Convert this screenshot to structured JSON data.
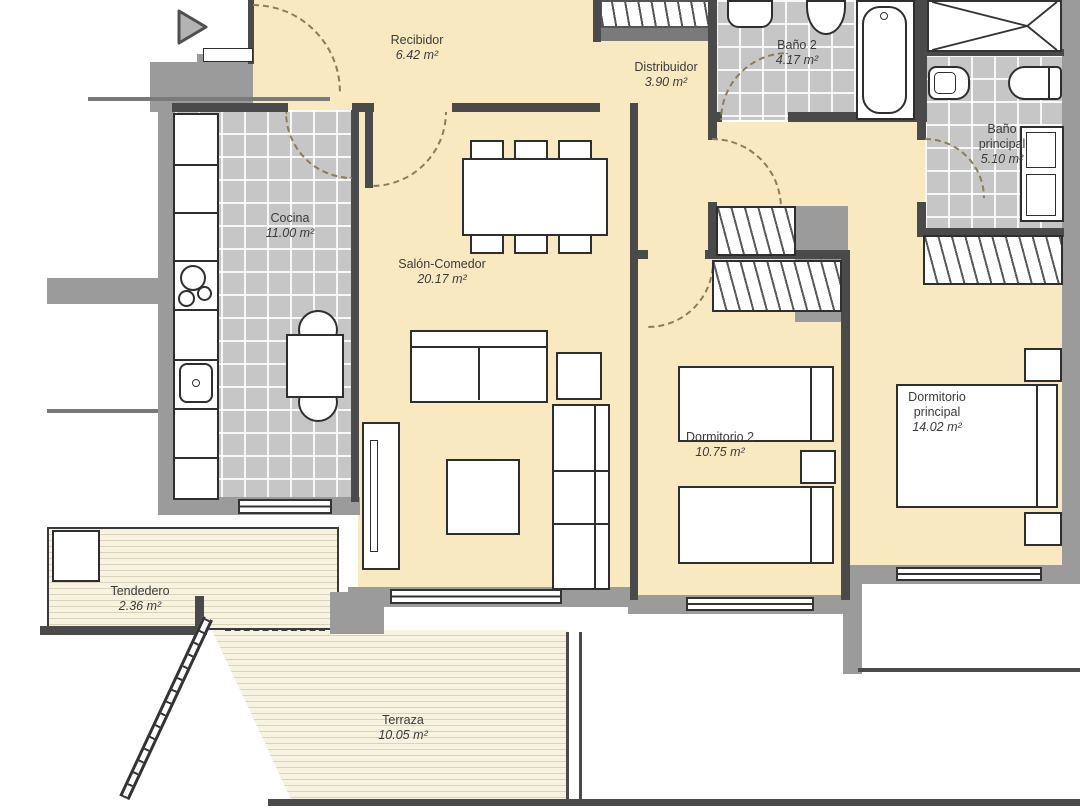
{
  "rooms": [
    {
      "id": "recibidor",
      "name": "Recibidor",
      "area": "6.42 m²"
    },
    {
      "id": "distribuidor",
      "name": "Distribuidor",
      "area": "3.90 m²"
    },
    {
      "id": "bano2",
      "name": "Baño 2",
      "area": "4.17 m²"
    },
    {
      "id": "bano_principal",
      "name": "Baño\nprincipal",
      "area": "5.10 m²"
    },
    {
      "id": "cocina",
      "name": "Cocina",
      "area": "11.00 m²"
    },
    {
      "id": "salon_comedor",
      "name": "Salón-Comedor",
      "area": "20.17 m²"
    },
    {
      "id": "dormitorio2",
      "name": "Dormitorio 2",
      "area": "10.75 m²"
    },
    {
      "id": "dormitorio_principal",
      "name": "Dormitorio\nprincipal",
      "area": "14.02 m²"
    },
    {
      "id": "tendedero",
      "name": "Tendedero",
      "area": "2.36 m²"
    },
    {
      "id": "terraza",
      "name": "Terraza",
      "area": "10.05 m²"
    }
  ],
  "play_button": {
    "icon": "play-icon"
  },
  "colors": {
    "floor_cream": "#f8e9c1",
    "tile_gray": "#c6c6c6",
    "wall_gray": "#9b9b9b",
    "wall_dark": "#4a4a4a",
    "deck_light": "#f7f3e0",
    "door_arc": "#8d7c55"
  }
}
